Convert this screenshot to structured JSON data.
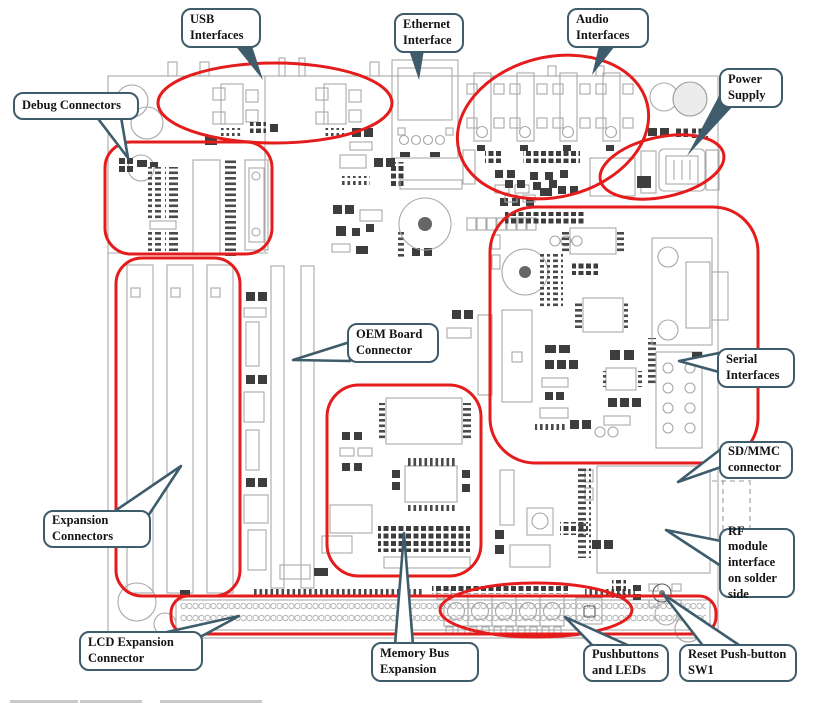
{
  "diagram": {
    "type": "annotated-pcb-board-diagram",
    "callouts": [
      {
        "id": "usb",
        "label": "USB\nInterfaces"
      },
      {
        "id": "ethernet",
        "label": "Ethernet\nInterface"
      },
      {
        "id": "audio",
        "label": "Audio\nInterfaces"
      },
      {
        "id": "power",
        "label": "Power\nSupply"
      },
      {
        "id": "debug",
        "label": "Debug Connectors"
      },
      {
        "id": "oem",
        "label": "OEM Board\nConnector"
      },
      {
        "id": "serial",
        "label": "Serial\nInterfaces"
      },
      {
        "id": "sdmmc",
        "label": "SD/MMC\nconnector"
      },
      {
        "id": "expansion",
        "label": "Expansion\nConnectors"
      },
      {
        "id": "lcd",
        "label": "LCD Expansion\nConnector"
      },
      {
        "id": "membus",
        "label": "Memory Bus\nExpansion"
      },
      {
        "id": "pushbuttons",
        "label": "Pushbuttons\nand LEDs"
      },
      {
        "id": "reset",
        "label": "Reset Push-button\nSW1"
      },
      {
        "id": "rf",
        "label": "RF module\ninterface\non solder\nside"
      }
    ]
  },
  "colors": {
    "highlight_red": "#e41c1c",
    "callout_border": "#3e5c6b",
    "callout_text": "#141414",
    "silkscreen_gray": "#a8a8a8",
    "component_dark": "#3d3d3d",
    "board_fill": "#ffffff"
  }
}
